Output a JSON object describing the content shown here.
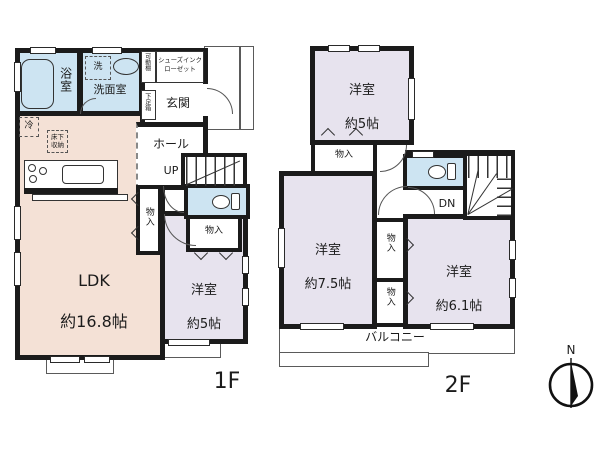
{
  "title": "floor-plan",
  "palette": {
    "wall": "#1b1b1b",
    "wet_room_blue": "#cde4f2",
    "ldk_beige": "#f4e1d6",
    "bedroom_purple": "#e7e3ee"
  },
  "f1": {
    "floor_label": "1F",
    "ldk_name": "LDK",
    "ldk_size": "約16.8帖",
    "bath": "浴室",
    "washroom": "洗面室",
    "washer": "洗",
    "fridge": "冷",
    "underfloor_storage": "床下収納",
    "movable_shelf": "可動棚",
    "shoe_closet": "シューズインクローゼット",
    "shoe_box": "下足箱",
    "entrance": "玄関",
    "hall": "ホール",
    "up": "UP",
    "closet_side": "物入",
    "closet_small": "物入",
    "room5_name": "洋室",
    "room5_size": "約5帖"
  },
  "f2": {
    "floor_label": "2F",
    "room5_name": "洋室",
    "room5_size": "約5帖",
    "room75_name": "洋室",
    "room75_size": "約7.5帖",
    "room61_name": "洋室",
    "room61_size": "約6.1帖",
    "closet_top": "物入",
    "closet_a": "物入",
    "closet_b": "物入",
    "dn": "DN",
    "balcony": "バルコニー"
  },
  "compass": {
    "north": "N"
  }
}
